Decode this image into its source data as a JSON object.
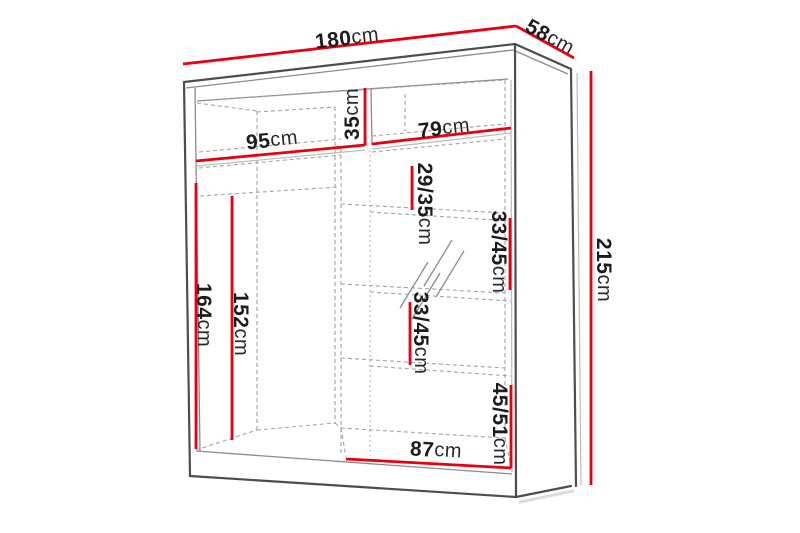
{
  "diagram": {
    "accent_color": "#e8000f",
    "outline_color": "#4d4d4d",
    "hidden_line_color": "#a3a3a3",
    "unit": "cm",
    "dimensions": {
      "total_width": {
        "value": "180",
        "unit": "cm"
      },
      "total_depth": {
        "value": "58",
        "unit": "cm"
      },
      "total_height": {
        "value": "215",
        "unit": "cm"
      },
      "left_opening_width": {
        "value": "95",
        "unit": "cm"
      },
      "top_shelf_height": {
        "value": "35",
        "unit": "cm"
      },
      "right_opening_width": {
        "value": "79",
        "unit": "cm"
      },
      "shelf_space_top": {
        "value": "29/35",
        "unit": "cm"
      },
      "shelf_space_upper": {
        "value": "33/45",
        "unit": "cm"
      },
      "shelf_space_lower": {
        "value": "33/45",
        "unit": "cm"
      },
      "shelf_space_bottom": {
        "value": "45/51",
        "unit": "cm"
      },
      "left_interior_height": {
        "value": "164",
        "unit": "cm"
      },
      "rail_height": {
        "value": "152",
        "unit": "cm"
      },
      "bottom_inner_width": {
        "value": "87",
        "unit": "cm"
      }
    }
  }
}
